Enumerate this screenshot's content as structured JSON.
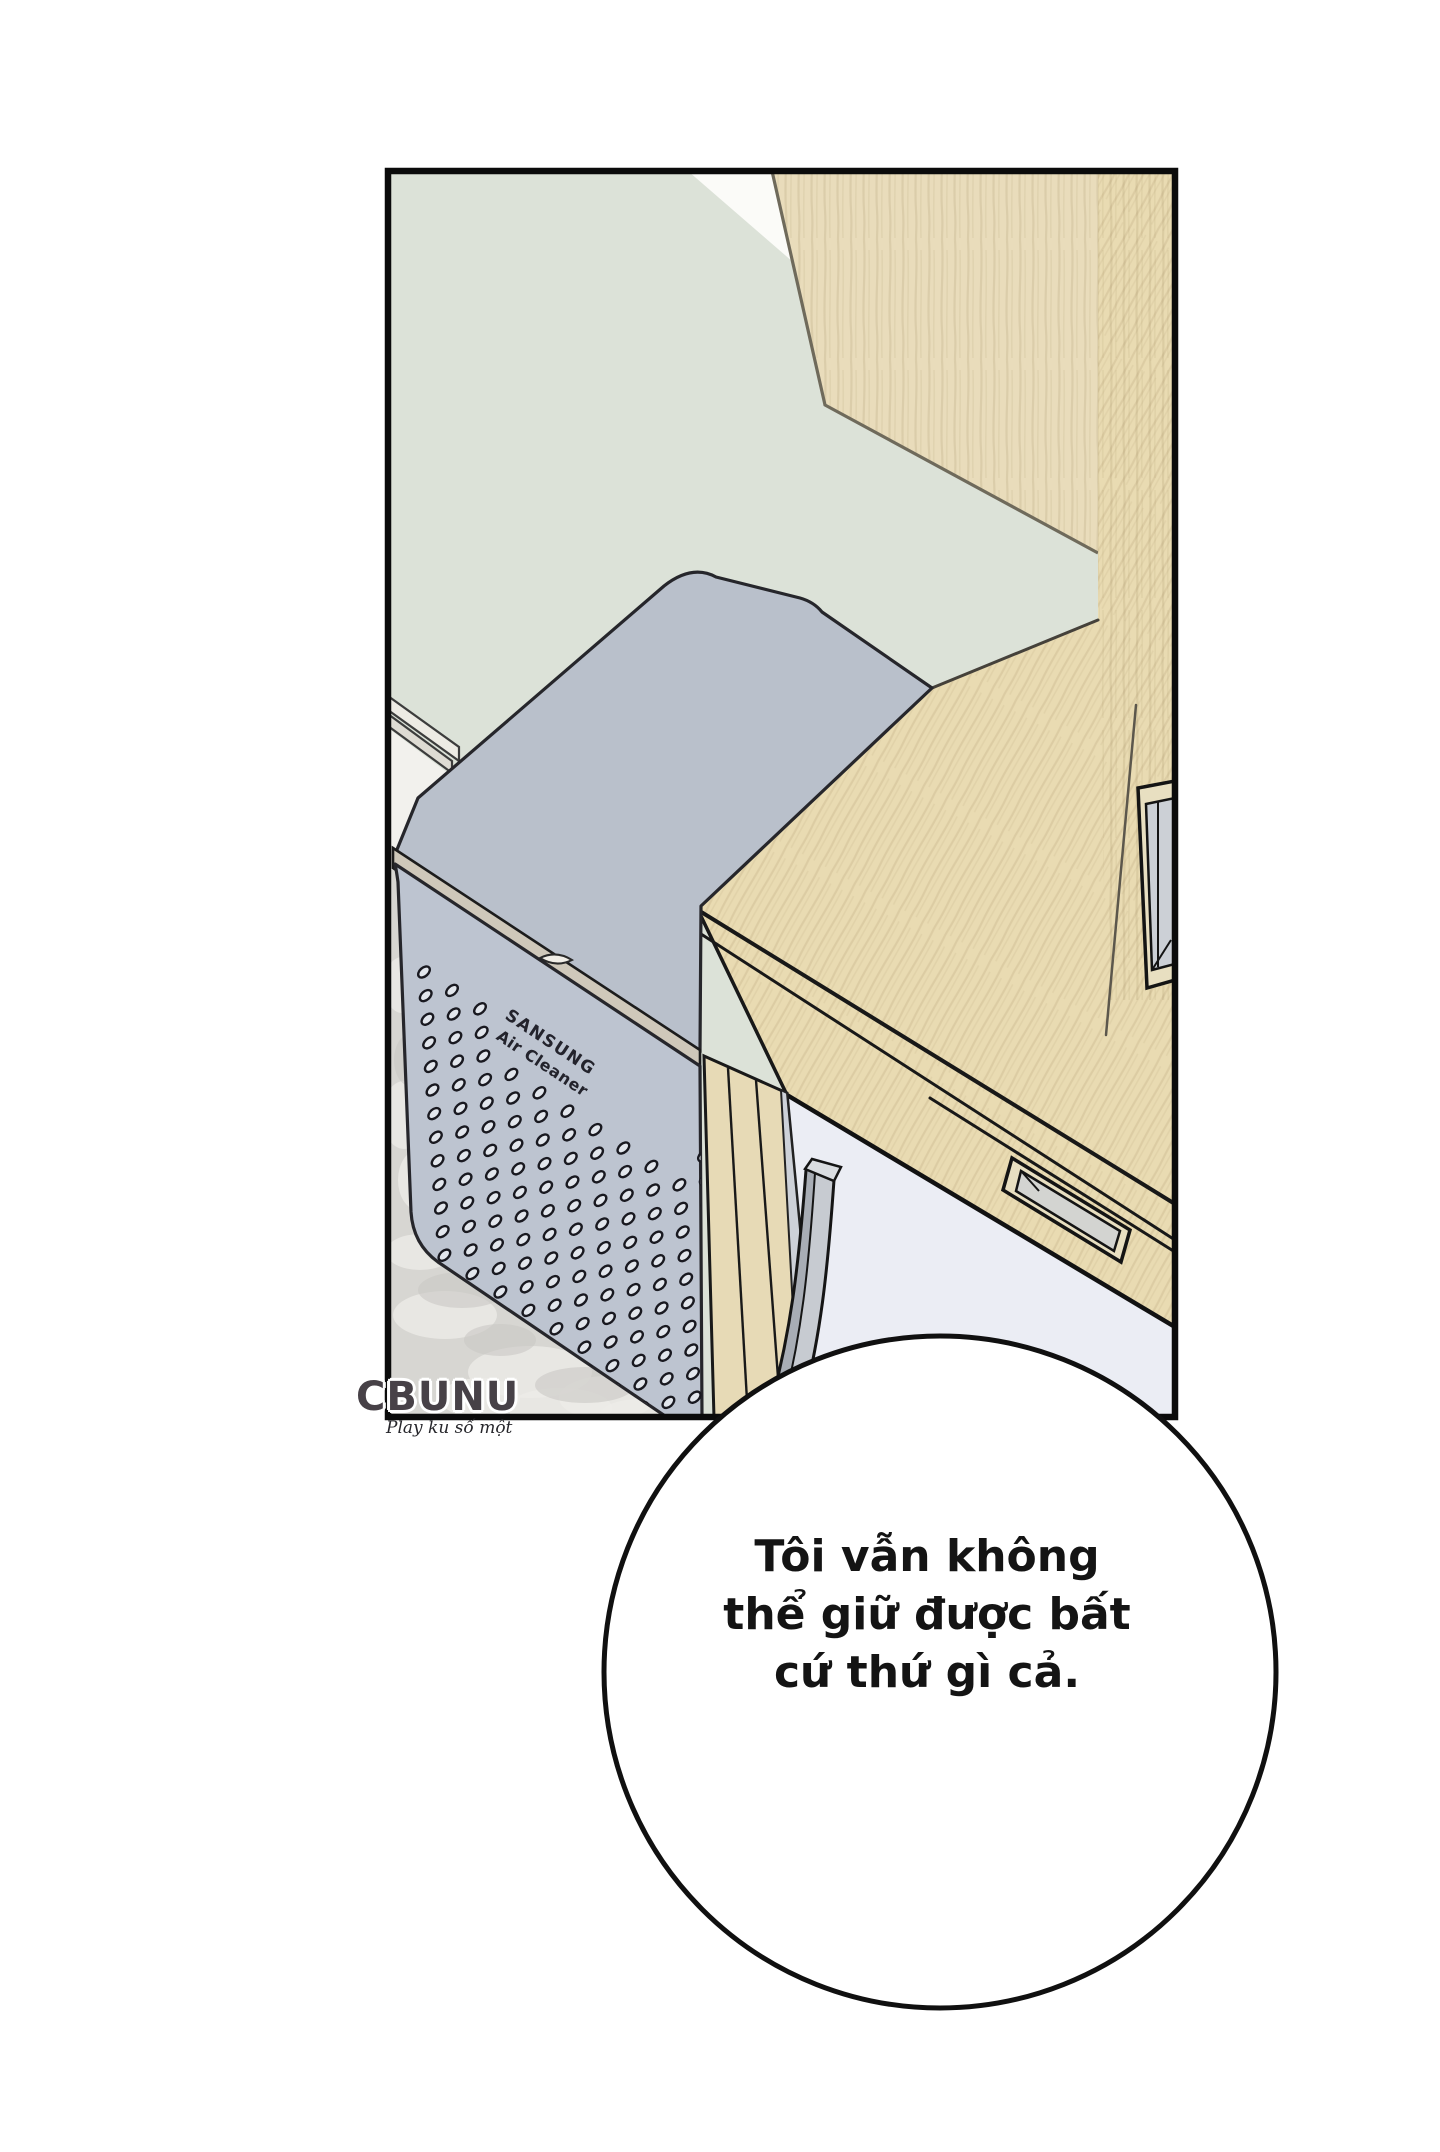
{
  "air_cleaner": {
    "brand": "SANSUNG",
    "product_label": "Air Cleaner"
  },
  "watermark": {
    "logo": "CBUNU",
    "tagline": "Play ku số một"
  },
  "speech_bubble": {
    "lines": [
      "Tôi vẫn không",
      "thể giữ được bất",
      "cứ thứ gì cả."
    ]
  },
  "colors": {
    "page_background": "#ffffff",
    "panel_border": "#0b0b0b",
    "wall": "#dce2d8",
    "wood_cabinet": "#e9dcbb",
    "wood_desk": "#e9dbb2",
    "cleaner_top": "#b9c0cb",
    "cleaner_front": "#bdc4d0",
    "cleaner_dot_fill": "#e2e6ec",
    "carpet": "#d7d6d2",
    "under_desk": "#ebedf4",
    "chair_leg": "#c7cbd1",
    "bubble_fill": "#ffffff",
    "outline": "#1a1a1a"
  }
}
